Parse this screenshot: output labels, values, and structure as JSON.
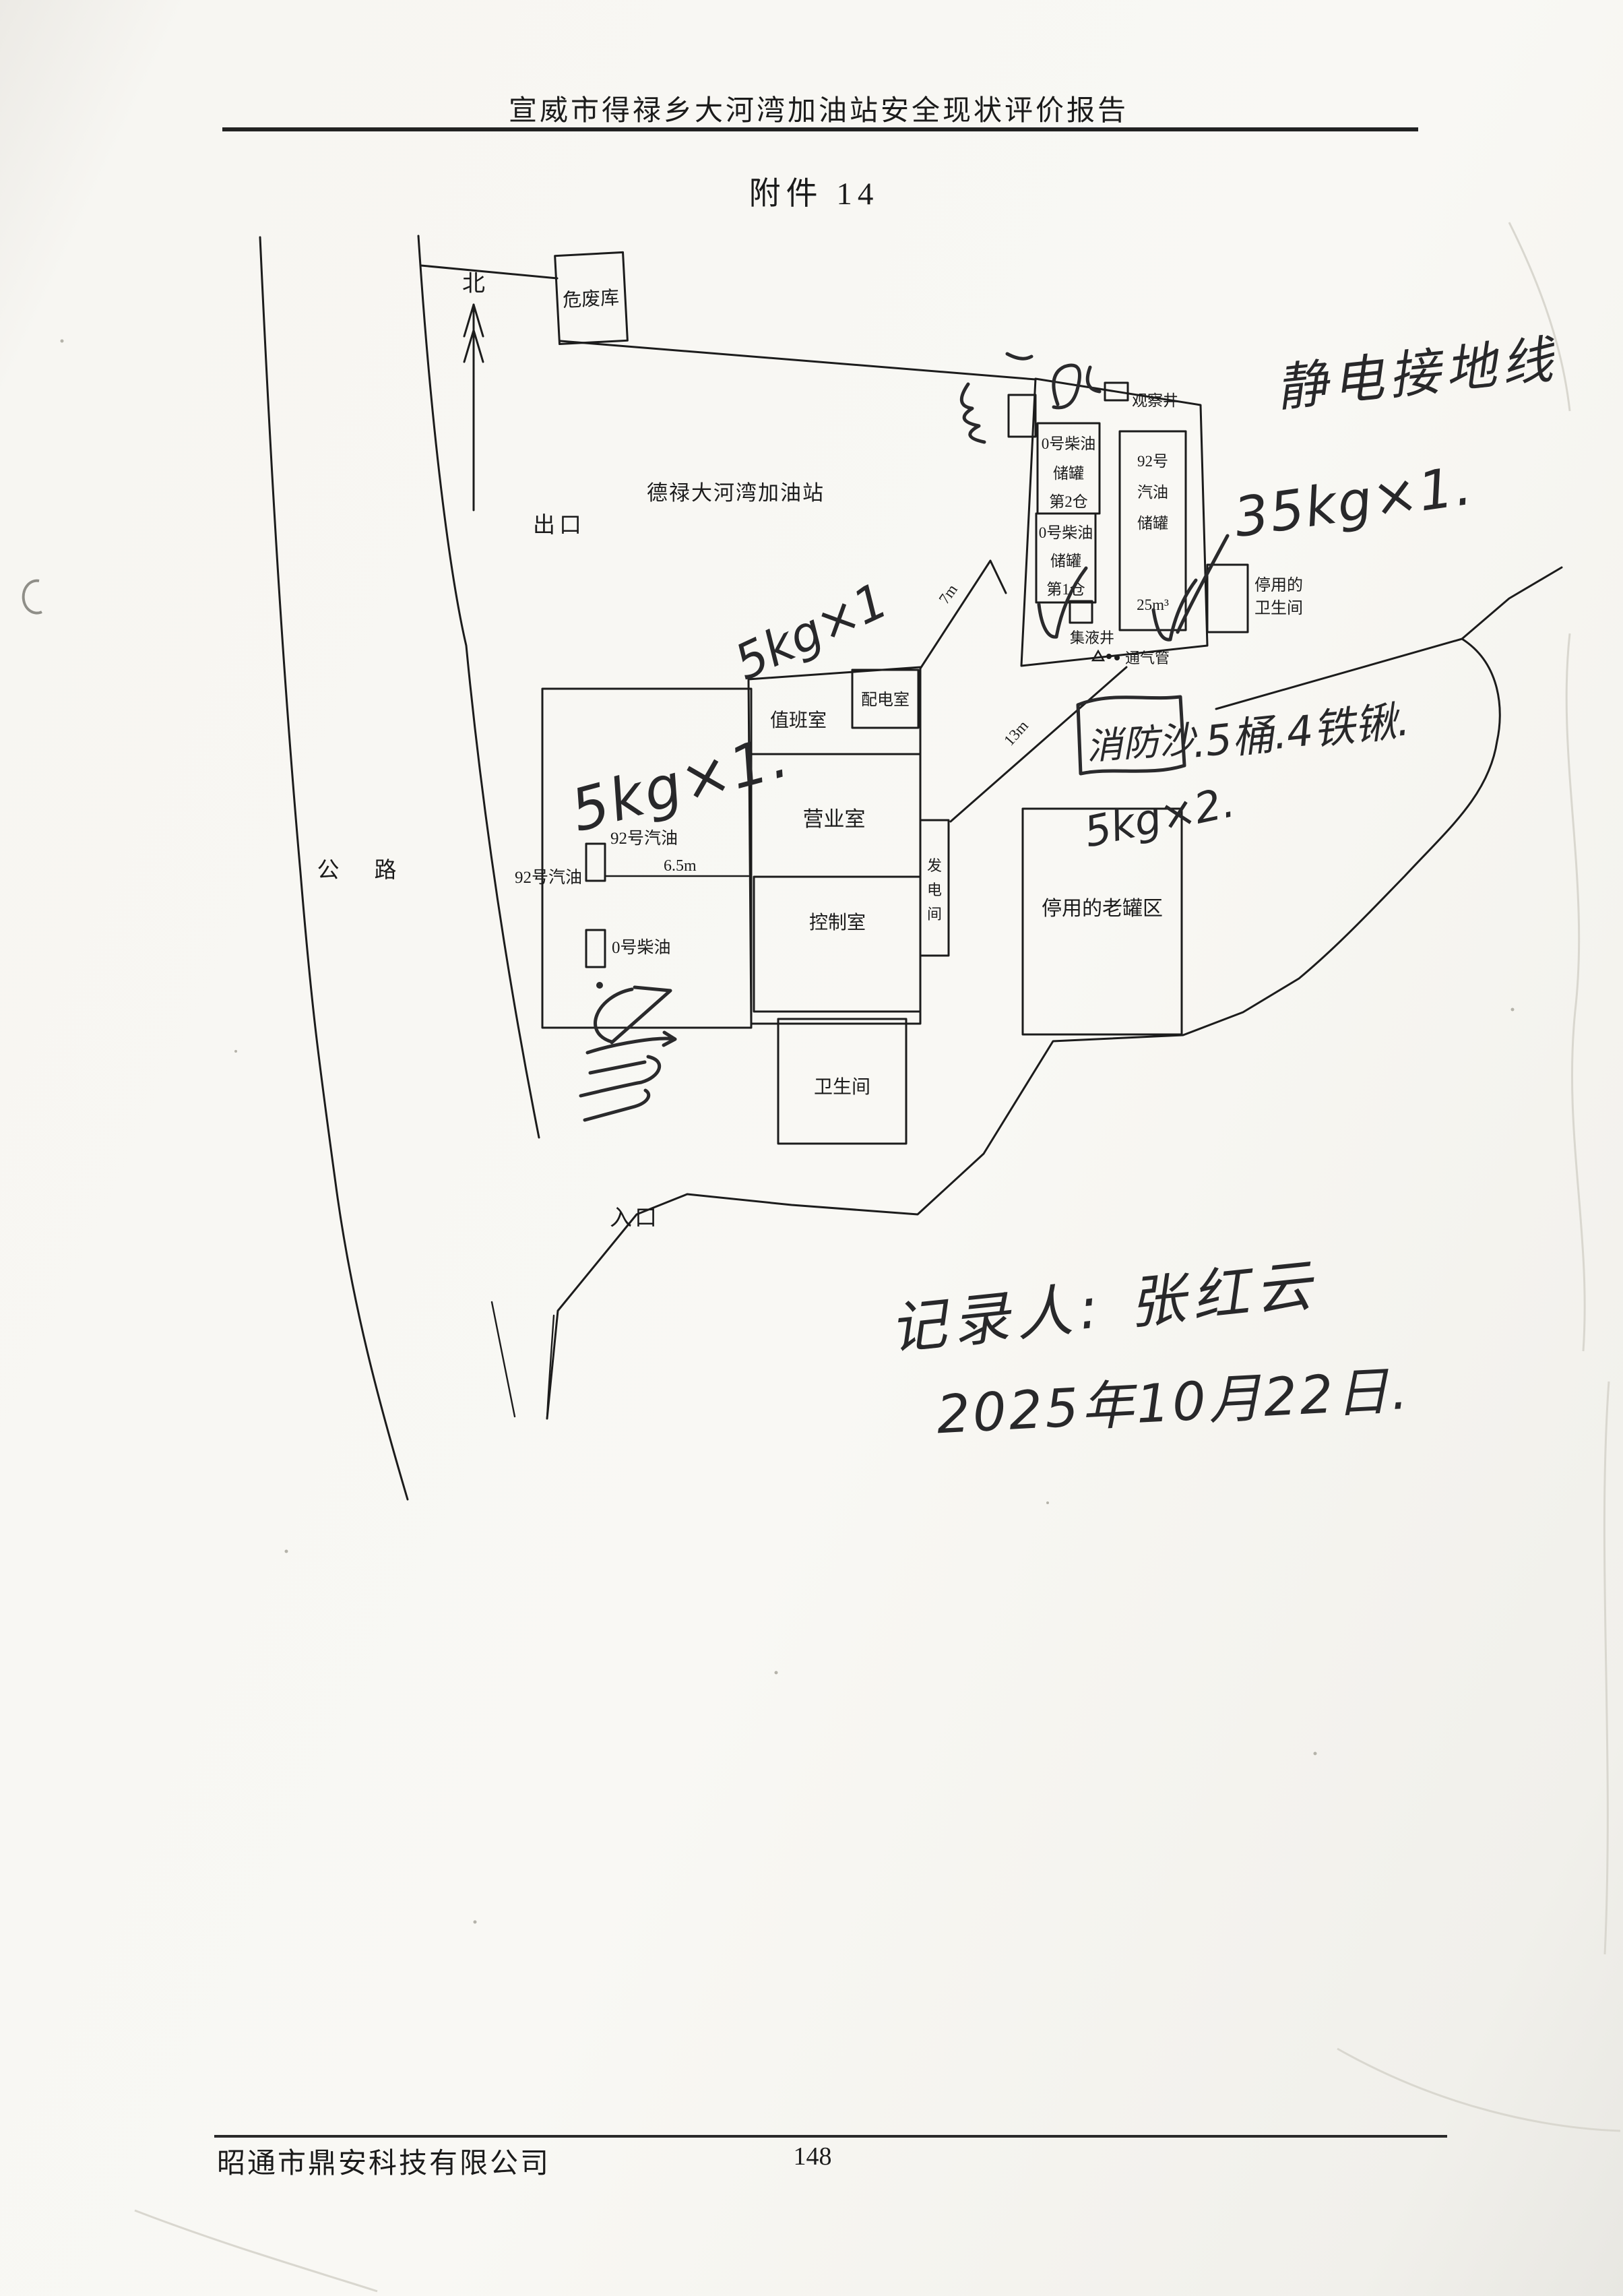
{
  "colors": {
    "paper": "#f7f6f2",
    "ink": "#1c1c1c",
    "handwriting": "#28282a",
    "crease": "#d9d7cf"
  },
  "header": {
    "report_title": "宣威市得禄乡大河湾加油站安全现状评价报告"
  },
  "document": {
    "attachment_title": "附件 14"
  },
  "footer": {
    "company_name": "昭通市鼎安科技有限公司",
    "page_number": "148"
  },
  "site_plan": {
    "compass": "北",
    "station_name": "德禄大河湾加油站",
    "labels": {
      "exit": "出口",
      "entrance": "入口",
      "road_char_1": "公",
      "road_char_2": "路",
      "hazardous_waste_store": "危废库",
      "observation_well": "观察井",
      "sump_well": "集液井",
      "vent_pipe": "通气管",
      "duty_room": "值班室",
      "power_distribution_room": "配电室",
      "business_room": "营业室",
      "control_room": "控制室",
      "toilet": "卫生间",
      "disused_old_tank_area": "停用的老罐区",
      "dispenser_92_left": "92号汽油",
      "dispenser_92_right": "92号汽油",
      "dispenser_0": "0号柴油"
    },
    "tanks": {
      "diesel_bay2_lines": [
        "0号柴油",
        "储罐",
        "第2仓"
      ],
      "diesel_bay1_lines": [
        "0号柴油",
        "储罐",
        "第1仓"
      ],
      "gasoline_lines": [
        "92号",
        "汽油",
        "储罐"
      ],
      "gasoline_volume": "25m³"
    },
    "disused_toilet_lines": [
      "停用的",
      "卫生间"
    ],
    "generator_room_chars": [
      "发",
      "电",
      "间"
    ],
    "dimensions": {
      "island_to_building": "6.5m",
      "building_to_tank_area": "7m",
      "vent_to_building": "13m"
    }
  },
  "handwriting": {
    "grounding_note": "静电接地线",
    "ext_35kg": "35kg×1.",
    "ext_5kg_island": "5kg×1.",
    "ext_5kg_power": "5kg×1",
    "fire_sand": "消防沙",
    "fire_sand_detail": ".5桶.4铁锹.",
    "ext_5kg_x2": "5kg×2.",
    "recorder": "记录人: 张红云",
    "record_date": "2025年10月22日.",
    "corner_scribble_reading": "油2"
  }
}
